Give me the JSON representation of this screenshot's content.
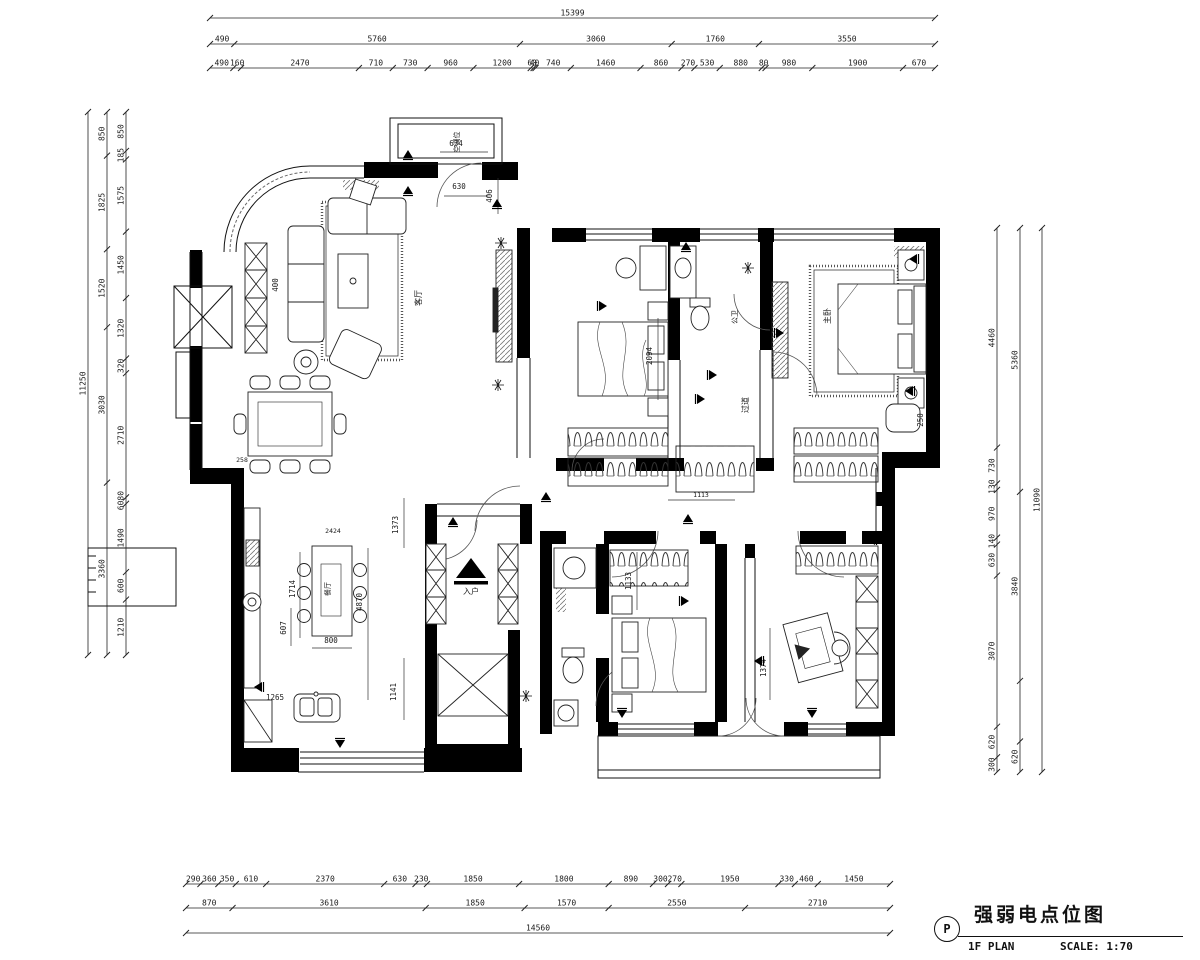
{
  "title_block": {
    "symbol": "P",
    "title": "强弱电点位图",
    "plan_label": "1F PLAN",
    "scale_label": "SCALE: 1:70"
  },
  "dim_chains": [
    {
      "id": "top-total",
      "orient": "h",
      "x1": 210,
      "x2": 935,
      "y": 18,
      "items": [
        "15399"
      ]
    },
    {
      "id": "top-major",
      "orient": "h",
      "x1": 210,
      "x2": 935,
      "y": 44,
      "items": [
        "490",
        "5760",
        "3060",
        "1760",
        "3550"
      ]
    },
    {
      "id": "top-minor",
      "orient": "h",
      "x1": 210,
      "x2": 935,
      "y": 68,
      "items": [
        "490",
        "160",
        "2470",
        "710",
        "730",
        "960",
        "1200",
        "60",
        "40",
        "740",
        "1460",
        "860",
        "270",
        "530",
        "880",
        "80",
        "980",
        "1900",
        "670"
      ]
    },
    {
      "id": "bottom-minor",
      "orient": "h",
      "x1": 186,
      "x2": 890,
      "y": 884,
      "items": [
        "290",
        "360",
        "350",
        "610",
        "2370",
        "630",
        "230",
        "1850",
        "1800",
        "890",
        "300",
        "270",
        "1950",
        "330",
        "460",
        "1450"
      ]
    },
    {
      "id": "bottom-major",
      "orient": "h",
      "x1": 186,
      "x2": 890,
      "y": 908,
      "items": [
        "870",
        "3610",
        "1850",
        "1570",
        "2550",
        "2710"
      ]
    },
    {
      "id": "bottom-total",
      "orient": "h",
      "x1": 186,
      "x2": 890,
      "y": 933,
      "items": [
        "14560"
      ]
    },
    {
      "id": "left-total",
      "orient": "v",
      "y1": 112,
      "y2": 655,
      "x": 88,
      "items": [
        "11250"
      ]
    },
    {
      "id": "left-major",
      "orient": "v",
      "y1": 112,
      "y2": 655,
      "x": 107,
      "items": [
        "850",
        "1825",
        "1520",
        "3030",
        "3360"
      ]
    },
    {
      "id": "left-minor",
      "orient": "v",
      "y1": 112,
      "y2": 655,
      "x": 126,
      "items": [
        "850",
        "185",
        "1575",
        "1450",
        "1320",
        "320",
        "2710",
        {
          "t": "6080",
          "v": 140
        },
        "1490",
        "600",
        "1210"
      ]
    },
    {
      "id": "right-minor",
      "orient": "v",
      "y1": 228,
      "y2": 772,
      "x": 997,
      "items": [
        "4460",
        "730",
        "130",
        "970",
        "140",
        "630",
        "3070",
        "620",
        "300"
      ]
    },
    {
      "id": "right-major",
      "orient": "v",
      "y1": 228,
      "y2": 772,
      "x": 1020,
      "items": [
        "5360",
        "3840",
        {
          "t": "",
          "v": 1230
        },
        "620"
      ]
    },
    {
      "id": "right-total",
      "orient": "v",
      "y1": 228,
      "y2": 772,
      "x": 1042,
      "items": [
        "11090"
      ]
    }
  ],
  "annotations": {
    "dims": [
      {
        "t": "634",
        "x": 456,
        "y": 146
      },
      {
        "t": "630",
        "x": 459,
        "y": 189
      },
      {
        "t": "406",
        "x": 492,
        "y": 196,
        "rot": true
      },
      {
        "t": "400",
        "x": 278,
        "y": 285,
        "rot": true
      },
      {
        "t": "258",
        "x": 242,
        "y": 462,
        "s": 6.5
      },
      {
        "t": "2424",
        "x": 333,
        "y": 533,
        "s": 6.5
      },
      {
        "t": "1714",
        "x": 295,
        "y": 589,
        "rot": true
      },
      {
        "t": "607",
        "x": 286,
        "y": 628,
        "rot": true
      },
      {
        "t": "800",
        "x": 331,
        "y": 643
      },
      {
        "t": "4870",
        "x": 362,
        "y": 602,
        "rot": true
      },
      {
        "t": "1373",
        "x": 398,
        "y": 525,
        "rot": true
      },
      {
        "t": "1141",
        "x": 396,
        "y": 692,
        "rot": true
      },
      {
        "t": "1265",
        "x": 275,
        "y": 700
      },
      {
        "t": "2094",
        "x": 652,
        "y": 356,
        "rot": true
      },
      {
        "t": "1133",
        "x": 631,
        "y": 581,
        "rot": true
      },
      {
        "t": "1113",
        "x": 701,
        "y": 497,
        "s": 6.5
      },
      {
        "t": "1374",
        "x": 766,
        "y": 668,
        "rot": true
      },
      {
        "t": "250",
        "x": 923,
        "y": 420,
        "rot": true
      }
    ],
    "labels": [
      {
        "t": "空调位",
        "x": 459,
        "y": 142,
        "rot": true,
        "s": 7
      },
      {
        "t": "客厅",
        "x": 421,
        "y": 298,
        "rot": true,
        "s": 8
      },
      {
        "t": "餐厅",
        "x": 330,
        "y": 589,
        "rot": true,
        "s": 7
      },
      {
        "t": "公卫",
        "x": 737,
        "y": 317,
        "rot": true,
        "s": 7
      },
      {
        "t": "过道",
        "x": 748,
        "y": 405,
        "rot": true,
        "s": 8
      },
      {
        "t": "主卧",
        "x": 830,
        "y": 316,
        "rot": true,
        "s": 8
      },
      {
        "t": "入户",
        "x": 471,
        "y": 594,
        "s": 8
      }
    ]
  },
  "symbols": {
    "sockets": [
      {
        "x": 408,
        "y": 155,
        "r": 0
      },
      {
        "x": 408,
        "y": 191,
        "r": 0
      },
      {
        "x": 497,
        "y": 204,
        "r": 0
      },
      {
        "x": 686,
        "y": 247,
        "r": 0
      },
      {
        "x": 712,
        "y": 375,
        "r": 90
      },
      {
        "x": 688,
        "y": 519,
        "r": 0
      },
      {
        "x": 684,
        "y": 601,
        "r": 90
      },
      {
        "x": 622,
        "y": 713,
        "r": 180
      },
      {
        "x": 759,
        "y": 661,
        "r": 270
      },
      {
        "x": 812,
        "y": 713,
        "r": 180
      },
      {
        "x": 910,
        "y": 391,
        "r": 270
      },
      {
        "x": 779,
        "y": 333,
        "r": 90
      },
      {
        "x": 546,
        "y": 497,
        "r": 0
      },
      {
        "x": 340,
        "y": 743,
        "r": 180
      },
      {
        "x": 259,
        "y": 687,
        "r": 270
      },
      {
        "x": 872,
        "y": 540,
        "r": 270
      },
      {
        "x": 453,
        "y": 522,
        "r": 0
      },
      {
        "x": 700,
        "y": 399,
        "r": 90
      },
      {
        "x": 914,
        "y": 259,
        "r": 270
      },
      {
        "x": 602,
        "y": 306,
        "r": 90
      }
    ],
    "stars": [
      {
        "x": 501,
        "y": 243
      },
      {
        "x": 498,
        "y": 385
      },
      {
        "x": 748,
        "y": 268
      },
      {
        "x": 526,
        "y": 696
      }
    ]
  }
}
